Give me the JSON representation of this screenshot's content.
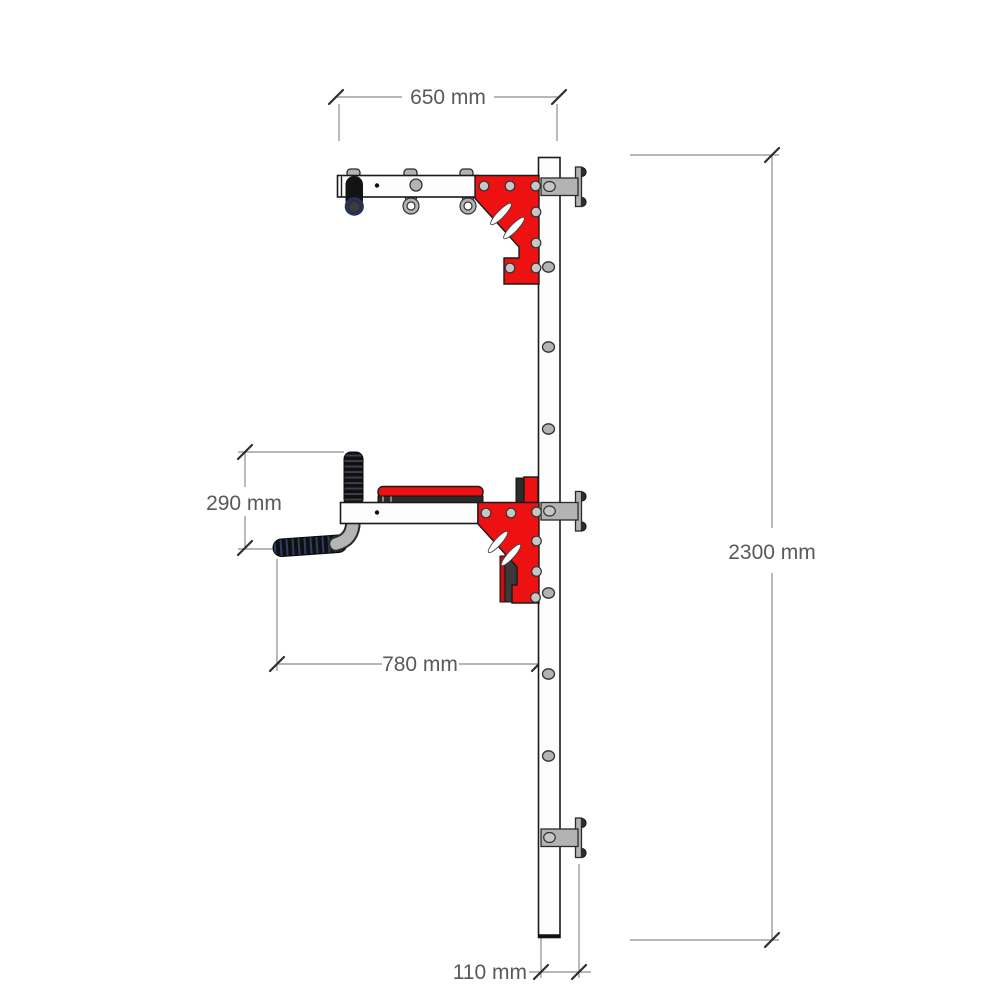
{
  "drawing": {
    "type": "technical-dimension-drawing",
    "subject": "wall-mounted pull-up and dip station, side view",
    "units": "mm",
    "dimensions": {
      "top_width": {
        "label": "650 mm",
        "value": 650
      },
      "overall_height": {
        "label": "2300 mm",
        "value": 2300
      },
      "handle_drop": {
        "label": "290 mm",
        "value": 290
      },
      "bottom_reach": {
        "label": "780 mm",
        "value": 780
      },
      "post_depth": {
        "label": "110 mm",
        "value": 110
      }
    },
    "colors": {
      "accent_red": "#ee1111",
      "steel_gray": "#b3b3b3",
      "outline_black": "#1a1a1a",
      "dim_line_gray": "#8c8c8c",
      "dim_text_gray": "#595959",
      "grip_black": "#121212"
    }
  }
}
